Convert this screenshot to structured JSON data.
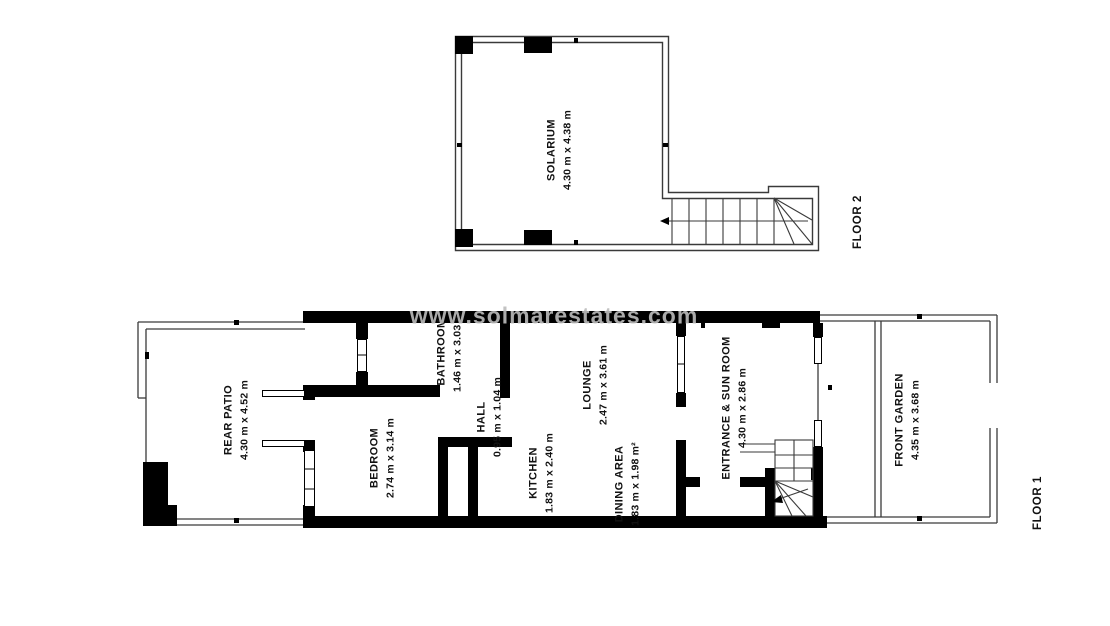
{
  "watermark": "www.solmarestates.com",
  "floor2": {
    "label": "FLOOR 2",
    "solarium": {
      "name": "SOLARIUM",
      "dims": "4.30 m x 4.38 m"
    }
  },
  "floor1": {
    "label": "FLOOR 1",
    "rear_patio": {
      "name": "REAR PATIO",
      "dims": "4.30 m x 4.52 m"
    },
    "bedroom": {
      "name": "BEDROOM",
      "dims": "2.74 m x 3.14 m"
    },
    "bathroom": {
      "name": "BATHROOM",
      "dims": "1.46 m x 3.03 m"
    },
    "hall": {
      "name": "HALL",
      "dims": "0.95 m x 1.04 m"
    },
    "kitchen": {
      "name": "KITCHEN",
      "dims": "1.83 m x 2.40 m"
    },
    "lounge": {
      "name": "LOUNGE",
      "dims": "2.47 m x 3.61 m"
    },
    "dining_area": {
      "name": "DINING AREA",
      "dims": "1.83 m x 1.98 m²"
    },
    "entrance_sun_room": {
      "name": "ENTRANCE & SUN ROOM",
      "dims": "4.30 m x 2.86 m"
    },
    "front_garden": {
      "name": "FRONT GARDEN",
      "dims": "4.35 m x 3.68 m"
    }
  },
  "colors": {
    "wall": "#000000",
    "line": "#3a3a3a",
    "watermark": "#bdbdbd",
    "background": "#ffffff"
  }
}
